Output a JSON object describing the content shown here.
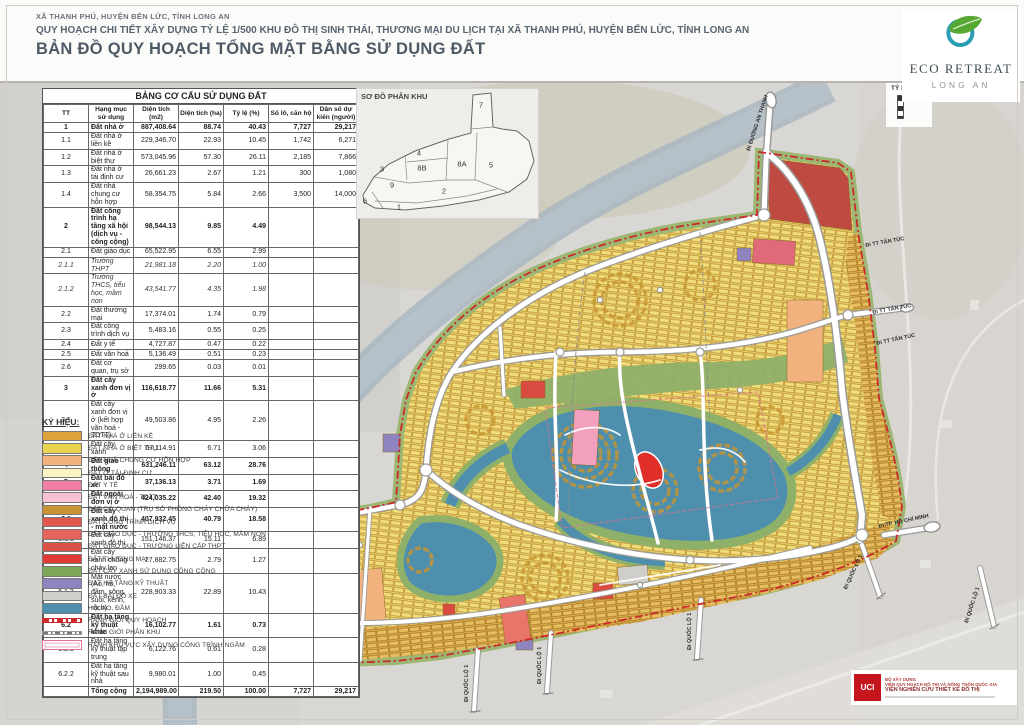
{
  "header": {
    "location_line": "XÃ THANH PHÚ, HUYỆN BẾN LỨC, TỈNH LONG AN",
    "project_line": "QUY HOẠCH CHI TIẾT XÂY DỰNG TỶ LỆ 1/500 KHU ĐÔ THỊ SINH THÁI, THƯƠNG MẠI DU LỊCH TẠI XÃ THANH PHÚ, HUYỆN BẾN LỨC, TỈNH LONG AN",
    "map_title": "BẢN ĐỒ QUY HOẠCH TỔNG MẶT BẰNG SỬ DỤNG ĐẤT"
  },
  "logo": {
    "name": "ECO RETREAT",
    "subtitle": "LONG AN"
  },
  "scale_box": {
    "label": "TỶ LỆ:"
  },
  "land_use_table": {
    "title": "BẢNG CƠ CẤU SỬ DỤNG ĐẤT",
    "columns": [
      "TT",
      "Hạng mục sử dụng",
      "Diện tích (m2)",
      "Diện tích (ha)",
      "Tỷ lệ (%)",
      "Số lô, căn hộ",
      "Dân số dự kiến (người)"
    ],
    "rows": [
      [
        "1",
        "Đất nhà ở",
        "887,408.64",
        "88.74",
        "40.43",
        "7,727",
        "29,217",
        "b"
      ],
      [
        "1.1",
        "Đất nhà ở liền kề",
        "229,346.70",
        "22.93",
        "10.45",
        "1,742",
        "6,271",
        ""
      ],
      [
        "1.2",
        "Đất nhà ở biệt thự",
        "573,045.96",
        "57.30",
        "26.11",
        "2,185",
        "7,866",
        ""
      ],
      [
        "1.3",
        "Đất nhà ở tái định cư",
        "26,661.23",
        "2.67",
        "1.21",
        "300",
        "1,080",
        ""
      ],
      [
        "1.4",
        "Đất nhà chung cư hỗn hợp",
        "58,354.75",
        "5.84",
        "2.66",
        "3,500",
        "14,000",
        ""
      ],
      [
        "2",
        "Đất công trình hạ tầng xã hội (dịch vụ - công cộng)",
        "98,544.13",
        "9.85",
        "4.49",
        "",
        "",
        "b"
      ],
      [
        "2.1",
        "Đất giáo dục",
        "65,522.95",
        "6.55",
        "2.99",
        "",
        "",
        ""
      ],
      [
        "2.1.1",
        "Trường THPT",
        "21,981.18",
        "2.20",
        "1.00",
        "",
        "",
        "i"
      ],
      [
        "2.1.2",
        "Trường THCS, tiểu học, mầm non",
        "43,541.77",
        "4.35",
        "1.98",
        "",
        "",
        "i"
      ],
      [
        "2.2",
        "Đất thương mại",
        "17,374.01",
        "1.74",
        "0.79",
        "",
        "",
        ""
      ],
      [
        "2.3",
        "Đất công trình dịch vụ",
        "5,483.16",
        "0.55",
        "0.25",
        "",
        "",
        ""
      ],
      [
        "2.4",
        "Đất y tế",
        "4,727.87",
        "0.47",
        "0.22",
        "",
        "",
        ""
      ],
      [
        "2.5",
        "Đất văn hoá",
        "5,136.49",
        "0.51",
        "0.23",
        "",
        "",
        ""
      ],
      [
        "2.6",
        "Đất cơ quan, trụ sở",
        "299.65",
        "0.03",
        "0.01",
        "",
        "",
        ""
      ],
      [
        "3",
        "Đất cây xanh đơn vị ở",
        "116,618.77",
        "11.66",
        "5.31",
        "",
        "",
        "b"
      ],
      [
        "3.1",
        "Đất cây xanh đơn vị ở (kết hợp văn hoá - TDTT)",
        "49,503.86",
        "4.95",
        "2.26",
        "",
        "",
        ""
      ],
      [
        "3.2",
        "Đất cây xanh",
        "67,114.91",
        "6.71",
        "3.06",
        "",
        "",
        ""
      ],
      [
        "4",
        "Đất giao thông",
        "631,246.11",
        "63.12",
        "28.76",
        "",
        "",
        "bt"
      ],
      [
        "5",
        "Đất bãi đỗ xe",
        "37,136.13",
        "3.71",
        "1.69",
        "",
        "",
        "b"
      ],
      [
        "6",
        "Đất ngoài đơn vị ở",
        "424,035.22",
        "42.40",
        "19.32",
        "",
        "",
        "b"
      ],
      [
        "6.1",
        "Đất cây xanh đô thị - mặt nước",
        "407,932.45",
        "40.79",
        "18.58",
        "",
        "",
        "b"
      ],
      [
        "6.1.1",
        "Đất cây xanh đô thị",
        "151,146.37",
        "15.11",
        "6.89",
        "",
        "",
        ""
      ],
      [
        "6.1.2",
        "Đất cây xanh chống cháy lan",
        "27,882.75",
        "2.79",
        "1.27",
        "",
        "",
        ""
      ],
      [
        "6.1.3",
        "Mặt nước (Ao, hồ, đầm, sông, suối, kênh, rạch)",
        "228,903.33",
        "22.89",
        "10.43",
        "",
        "",
        ""
      ],
      [
        "6.2",
        "Đất hạ tầng kỹ thuật khác",
        "16,102.77",
        "1.61",
        "0.73",
        "",
        "",
        "b"
      ],
      [
        "6.2.1",
        "Đất hạ tầng kỹ thuật tập trung",
        "6,122.76",
        "0.61",
        "0.28",
        "",
        "",
        ""
      ],
      [
        "6.2.2",
        "Đất hạ tầng kỹ thuật sau nhà",
        "9,980.01",
        "1.00",
        "0.45",
        "",
        "",
        ""
      ],
      [
        "",
        "Tổng cộng",
        "2,194,989.00",
        "219.50",
        "100.00",
        "7,727",
        "29,217",
        "b"
      ]
    ]
  },
  "legend": {
    "title": "KÝ HIỆU:",
    "items": [
      {
        "label": "ĐẤT NHÀ Ở LIỀN KỀ",
        "color": "#dfa13c"
      },
      {
        "label": "ĐẤT NHÀ Ở BIỆT THỰ",
        "color": "#e8d34f"
      },
      {
        "label": "ĐẤT NHÀ CHUNG CƯ HỖN HỢP",
        "color": "#f2b27e"
      },
      {
        "label": "ĐẤT Ở TÁI ĐỊNH CƯ",
        "color": "#faf3c3"
      },
      {
        "label": "ĐẤT Y TẾ",
        "color": "#ef7fa2"
      },
      {
        "label": "ĐẤT VĂN HOÁ - TDTT",
        "color": "#f7c3d4"
      },
      {
        "label": "ĐẤT CƠ QUAN (TRỤ SỞ PHÒNG CHÁY CHỮA CHÁY)",
        "color": "#c99232"
      },
      {
        "label": "ĐẤT CÔNG TRÌNH DỊCH VỤ",
        "color": "#e2574c"
      },
      {
        "label": "ĐẤT GIÁO DỤC - TRƯỜNG THCS, TIỂU HỌC, MẦM NON",
        "color": "#e4635a"
      },
      {
        "label": "ĐẤT GIÁO DỤC - TRƯỜNG LIÊN CẤP THPT",
        "color": "#d95348"
      },
      {
        "label": "ĐẤT THƯƠNG MẠI",
        "color": "#e03a35"
      },
      {
        "label": "ĐẤT CÂY XANH SỬ DỤNG CÔNG CỘNG",
        "color": "#7fa75a"
      },
      {
        "label": "ĐẤT HẠ TẦNG KỸ THUẬT",
        "color": "#8f84c0"
      },
      {
        "label": "ĐẤT BÃI ĐỖ XE",
        "color": "#cfcecb"
      },
      {
        "label": "HỒ, AO, ĐẦM",
        "color": "#4f8fae"
      }
    ],
    "line_items": [
      {
        "label": "RANH GIỚI QUY HOẠCH",
        "type": "boundary"
      },
      {
        "label": "RANH GIỚI PHÂN KHU",
        "type": "subzone"
      },
      {
        "label": "RANH KHU VỰC XÂY DỰNG CÔNG TRÌNH NGẦM",
        "type": "underground"
      }
    ]
  },
  "inset": {
    "title": "SƠ ĐỒ PHÂN KHU",
    "zones": [
      "1",
      "2",
      "3",
      "4",
      "5",
      "6",
      "7",
      "8A",
      "8B",
      "9"
    ]
  },
  "map": {
    "road_labels": [
      {
        "id": "dt830",
        "text": "Đi ĐT 830"
      },
      {
        "id": "anthanh",
        "text": "Đi ĐƯỜNG AN THẠNH"
      },
      {
        "id": "tantuc1",
        "text": "Đi TT TÂN TÚC"
      },
      {
        "id": "tantuc2",
        "text": "Đi TT TÂN TÚC"
      },
      {
        "id": "tantuc3",
        "text": "Đi TT TÂN TÚC"
      },
      {
        "id": "hcm",
        "text": "Đi TP. HỒ CHÍ MINH"
      },
      {
        "id": "ql1a",
        "text": "Đi QUỐC LỘ 1"
      },
      {
        "id": "ql1b",
        "text": "Đi QUỐC LỘ 1"
      },
      {
        "id": "ql1c",
        "text": "Đi QUỐC LỘ 1"
      },
      {
        "id": "ql1d",
        "text": "Đi QUỐC LỘ 1"
      },
      {
        "id": "ql1e",
        "text": "Đi QUỐC LỘ 1"
      }
    ]
  },
  "publisher": {
    "logo_text": "UCI",
    "line1": "BỘ XÂY DỰNG",
    "line2": "VIỆN QUY HOẠCH ĐÔ THỊ VÀ NÔNG THÔN QUỐC GIA",
    "line3": "VIỆN NGHIÊN CỨU THIẾT KẾ ĐÔ THỊ"
  }
}
